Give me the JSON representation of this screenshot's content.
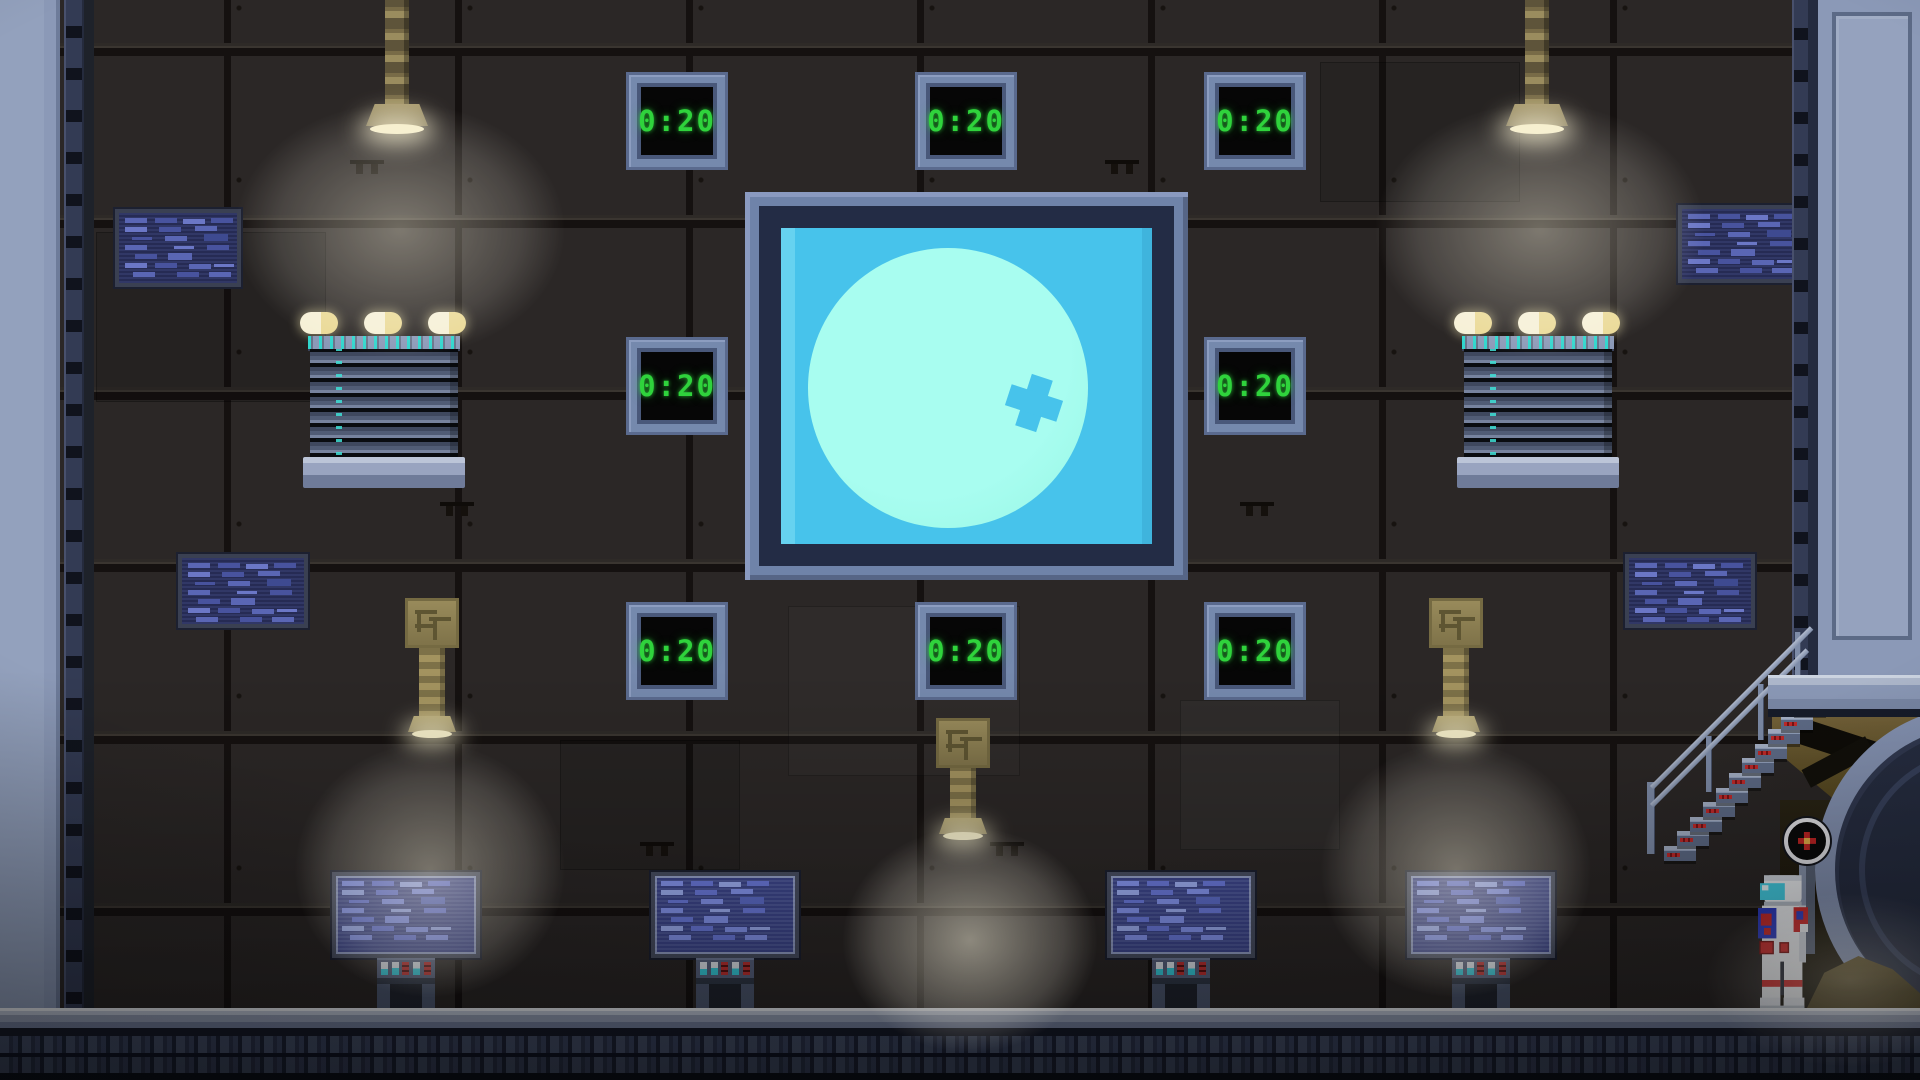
{
  "timers": {
    "values": [
      "0:20",
      "0:20",
      "0:20",
      "0:20",
      "0:20",
      "0:20",
      "0:20",
      "0:20"
    ]
  },
  "colors": {
    "timer_green": "#2fd33c",
    "timer_frame": "#7589ad",
    "sky_blue": "#47c3eb",
    "moon_mint": "#9ffbea",
    "metal_light": "#8b99b7",
    "wall_dark": "#2b2726",
    "hazard_red": "#c42a2a",
    "indicator_cyan": "#38d2e2",
    "screen_blue": "#262b54"
  },
  "icons": {
    "moon_crater": "cross-crater-icon",
    "gauge": "valve-gauge-icon",
    "astronaut": "astronaut-character"
  }
}
